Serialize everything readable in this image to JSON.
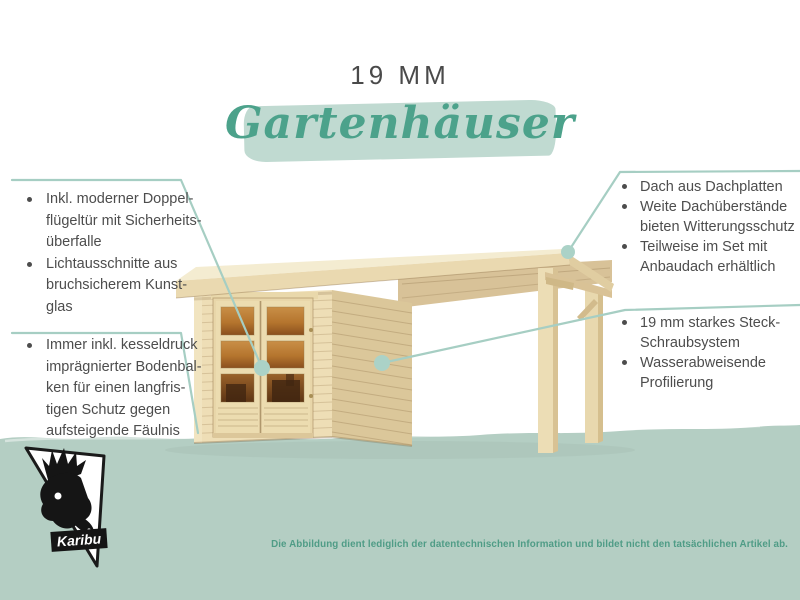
{
  "header": {
    "size_label": "19 MM",
    "title": "Gartenhäuser"
  },
  "features": {
    "left_top": {
      "items": [
        {
          "lines": [
            "Inkl. moderner Doppel-",
            "flügeltür mit Sicherheits-",
            "überfalle"
          ]
        },
        {
          "lines": [
            "Lichtausschnitte aus",
            "bruchsicherem Kunst-",
            "glas"
          ]
        }
      ]
    },
    "left_bottom": {
      "items": [
        {
          "lines": [
            "Immer inkl. kesseldruck",
            "imprägnierter Bodenbal-",
            "ken für einen langfris-",
            "tigen Schutz gegen",
            "aufsteigende Fäulnis"
          ]
        }
      ]
    },
    "right_top": {
      "items": [
        {
          "lines": [
            "Dach aus Dachplatten"
          ]
        },
        {
          "lines": [
            "Weite Dachüberstände",
            "bieten Witterungsschutz"
          ]
        },
        {
          "lines": [
            "Teilweise im Set mit",
            "Anbaudach erhältlich"
          ]
        }
      ]
    },
    "right_bottom": {
      "items": [
        {
          "lines": [
            "19 mm starkes Steck-",
            "Schraubsystem"
          ]
        },
        {
          "lines": [
            "Wasserabweisende",
            "Profilierung"
          ]
        }
      ]
    }
  },
  "illustration": {
    "icons": [
      "garden-shed-illustration",
      "canopy-posts",
      "callout-dot"
    ]
  },
  "logo": {
    "brand": "Karibu",
    "icon": "deer-head-icon"
  },
  "footer": {
    "disclaimer": "Die Abbildung dient lediglich der datentechnischen Information und bildet nicht den tatsächlichen Artikel ab."
  },
  "colors": {
    "accent_green": "#4ca28b",
    "brush_green": "#c0dad1",
    "band_green": "#b4cec3",
    "leader_line": "#a6cec3",
    "text_gray": "#4d4d4d",
    "disclaimer_green": "#4f9c86",
    "wood_light": "#eedeb6",
    "wood_shade": "#dbc79a",
    "window_amber": "#b5752e"
  }
}
